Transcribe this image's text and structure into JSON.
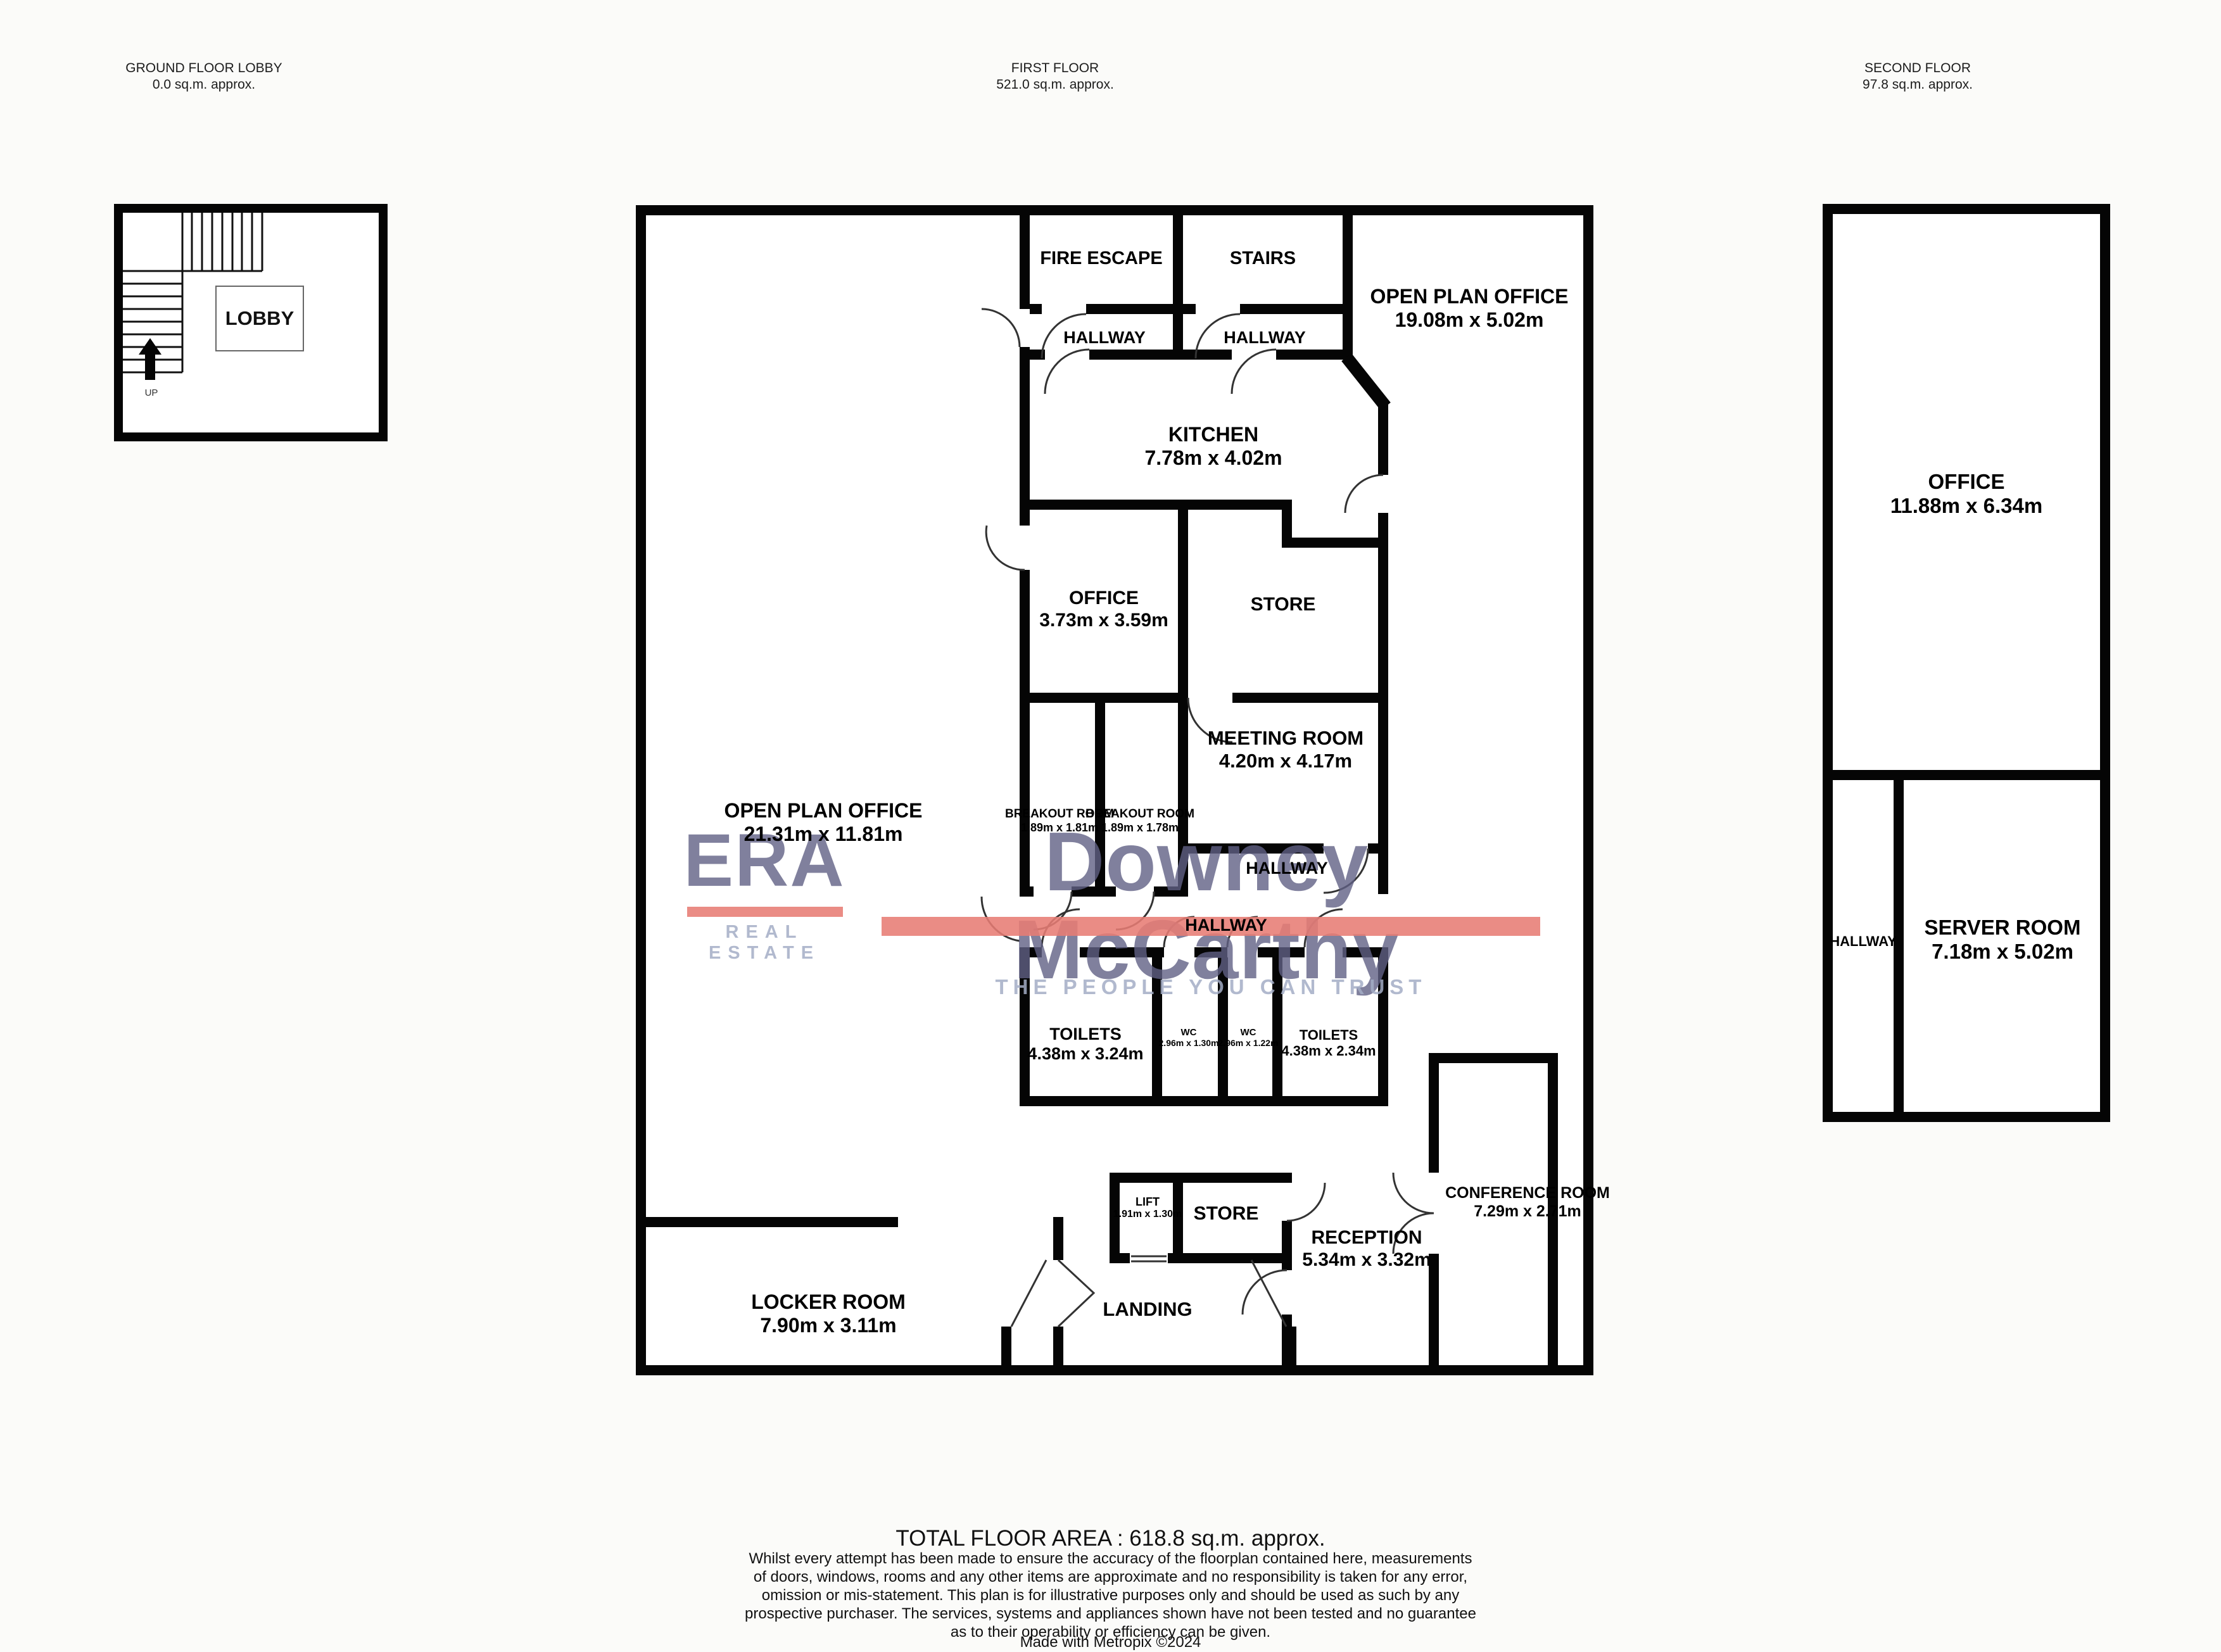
{
  "floors": {
    "ground": {
      "header_line1": "GROUND FLOOR LOBBY",
      "header_line2": "0.0 sq.m. approx.",
      "rooms": {
        "lobby": {
          "name": "LOBBY"
        }
      },
      "stairs_direction_label": "UP"
    },
    "first": {
      "header_line1": "FIRST FLOOR",
      "header_line2": "521.0 sq.m. approx.",
      "rooms": {
        "fire_escape": {
          "name": "FIRE ESCAPE"
        },
        "stairs_room": {
          "name": "STAIRS"
        },
        "open_plan_top": {
          "name": "OPEN PLAN OFFICE",
          "dims": "19.08m  x 5.02m"
        },
        "hallway_a": {
          "name": "HALLWAY"
        },
        "hallway_b": {
          "name": "HALLWAY"
        },
        "kitchen": {
          "name": "KITCHEN",
          "dims": "7.78m  x 4.02m"
        },
        "office": {
          "name": "OFFICE",
          "dims": "3.73m  x 3.59m"
        },
        "store_upper": {
          "name": "STORE"
        },
        "breakout_a": {
          "name": "BREAKOUT ROOM",
          "dims": "1.89m  x 1.81m"
        },
        "breakout_b": {
          "name": "BREAKOUT ROOM",
          "dims": "1.89m  x 1.78m"
        },
        "meeting": {
          "name": "MEETING ROOM",
          "dims": "4.20m  x 4.17m"
        },
        "open_plan_main": {
          "name": "OPEN PLAN OFFICE",
          "dims": "21.31m  x 11.81m"
        },
        "hallway_c": {
          "name": "HALLWAY"
        },
        "hallway_d": {
          "name": "HALLWAY"
        },
        "toilets_a": {
          "name": "TOILETS",
          "dims": "4.38m  x 3.24m"
        },
        "wc_a": {
          "name": "WC",
          "dims": "2.96m  x 1.30m"
        },
        "wc_b": {
          "name": "WC",
          "dims": "2.96m  x 1.22m"
        },
        "toilets_b": {
          "name": "TOILETS",
          "dims": "4.38m  x 2.34m"
        },
        "conference": {
          "name": "CONFERENCE ROOM",
          "dims": "7.29m  x 2.71m"
        },
        "lift": {
          "name": "LIFT",
          "dims": "1.91m  x 1.30m"
        },
        "store_lower": {
          "name": "STORE"
        },
        "reception": {
          "name": "RECEPTION",
          "dims": "5.34m  x 3.32m"
        },
        "locker": {
          "name": "LOCKER ROOM",
          "dims": "7.90m  x 3.11m"
        },
        "landing": {
          "name": "LANDING"
        }
      }
    },
    "second": {
      "header_line1": "SECOND FLOOR",
      "header_line2": "97.8 sq.m. approx.",
      "rooms": {
        "office": {
          "name": "OFFICE",
          "dims": "11.88m  x 6.34m"
        },
        "hallway": {
          "name": "HALLWAY"
        },
        "server": {
          "name": "SERVER ROOM",
          "dims": "7.18m  x 5.02m"
        }
      }
    }
  },
  "watermark": {
    "brand": "ERA",
    "brand_sub": "REAL ESTATE",
    "agency": "Downey McCarthy",
    "tagline": "THE PEOPLE YOU CAN TRUST",
    "colors": {
      "house_red": "#db7d76",
      "brand_text": "rgba(96,96,132,0.8)",
      "accent_bar": "rgba(231,124,116,0.88)",
      "tagline_text": "rgba(163,173,198,0.85)"
    }
  },
  "footer": {
    "total_area": "TOTAL FLOOR AREA : 618.8 sq.m. approx.",
    "disclaimer_lines": [
      "Whilst every attempt has been made to ensure the accuracy of the floorplan contained here, measurements",
      "of doors, windows, rooms and any other items are approximate and no responsibility is taken for any error,",
      "omission or mis-statement. This plan is for illustrative purposes only and should be used as such by any",
      "prospective purchaser. The services, systems and appliances shown have not been tested and no guarantee",
      "as to their operability or efficiency can be given."
    ],
    "credit": "Made with Metropix ©2024"
  }
}
